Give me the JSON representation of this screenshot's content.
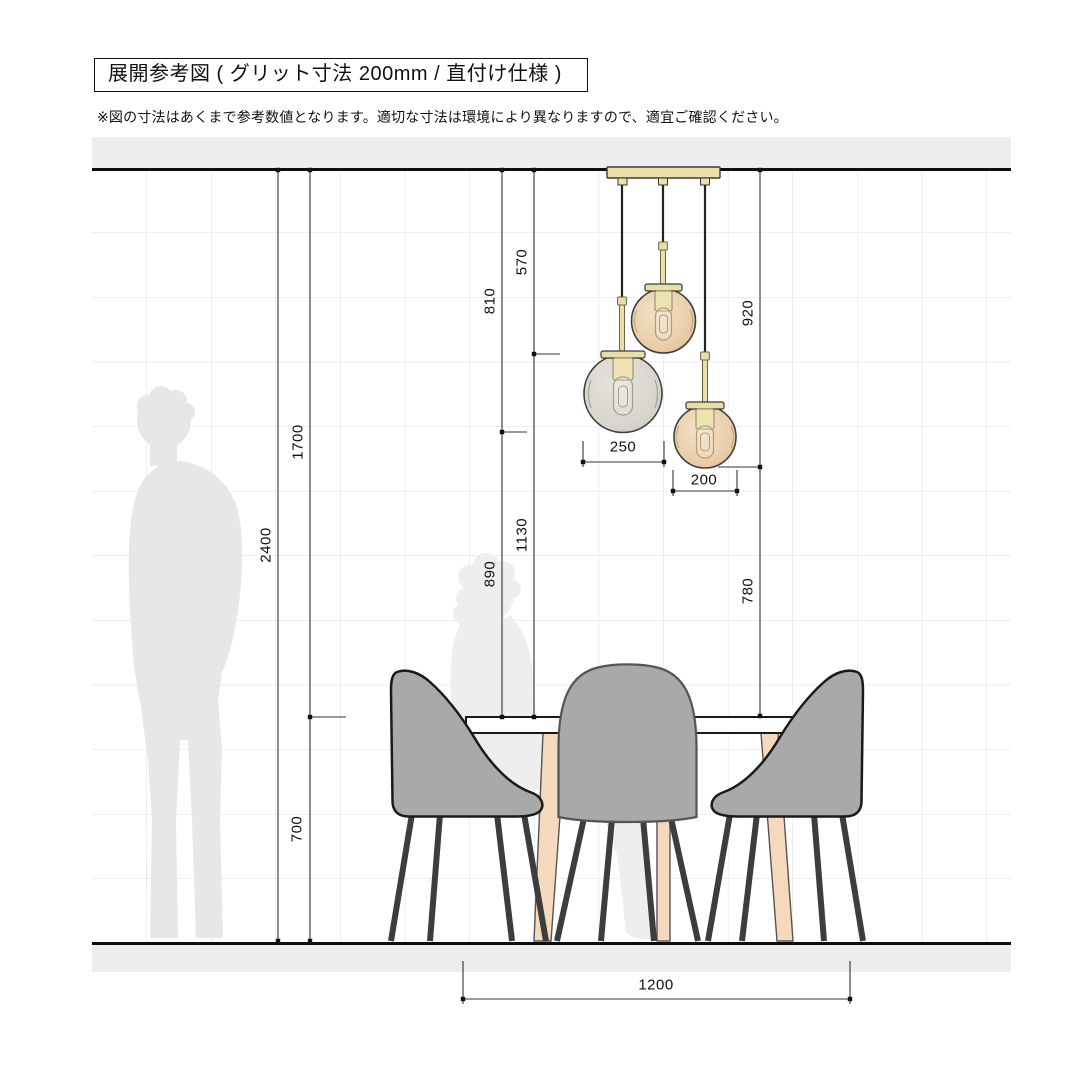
{
  "header": {
    "title": "展開参考図 ( グリット寸法 200mm / 直付け仕様 )",
    "note": "※図の寸法はあくまで参考数値となります。適切な寸法は環境により異なりますので、適宜ご確認ください。"
  },
  "drawing": {
    "type": "interior-elevation-reference",
    "grid_pitch_mm": 200,
    "mount_type": "直付け仕様",
    "dimensions": {
      "2400": "2400",
      "1700": "1700",
      "700": "700",
      "810": "810",
      "890": "890",
      "570": "570",
      "1130": "1130",
      "920": "920",
      "780": "780",
      "250": "250",
      "200": "200",
      "1200": "1200"
    },
    "measurements_mm": {
      "ceiling_to_floor": 2400,
      "ceiling_to_table_top": 1700,
      "table_height": 700,
      "table_width": 1200,
      "pendant_drop_short": 570,
      "pendant_drop_mid": 810,
      "pendant_drop_long": 920,
      "short_pendant_to_table": 1130,
      "mid_pendant_to_table": 890,
      "long_pendant_to_table": 780,
      "globe_diameter_large": 250,
      "globe_diameter_small": 200
    },
    "colors": {
      "amber_globe": "#e9cdaa",
      "smoke_globe": "#d8d5ce",
      "brass": "#e8dfa7",
      "chair_upholstery": "#a9a9a9",
      "wood_leg": "#f4d9bd",
      "silhouette": "#e7e7e7",
      "slab_gray": "#ededed",
      "grid_line": "#dcdcdc"
    }
  }
}
